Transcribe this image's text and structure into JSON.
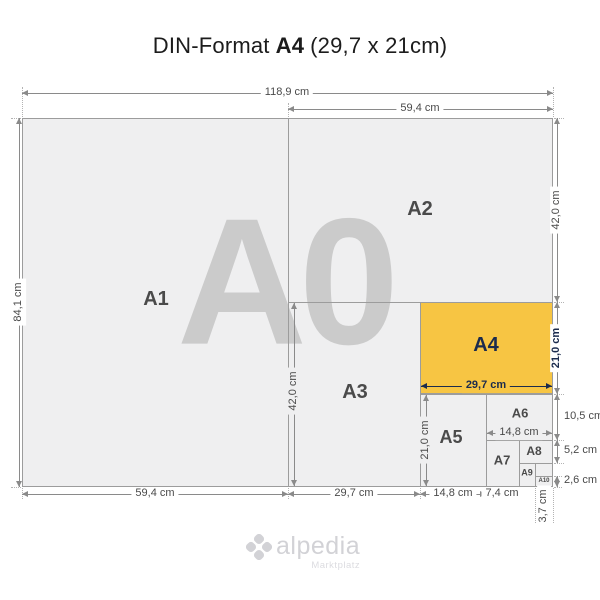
{
  "title": {
    "prefix": "DIN-Format",
    "highlight": "A4",
    "suffix": "(29,7 x 21cm)"
  },
  "watermark": "A0",
  "formats": {
    "a0": "A0",
    "a1": "A1",
    "a2": "A2",
    "a3": "A3",
    "a4": "A4",
    "a5": "A5",
    "a6": "A6",
    "a7": "A7",
    "a8": "A8",
    "a9": "A9",
    "a10": "A10"
  },
  "dims": {
    "total_width": "118,9 cm",
    "a2_width": "59,4 cm",
    "total_height": "84,1 cm",
    "a2_height": "42,0 cm",
    "a4_height": "21,0 cm",
    "a6_height": "10,5 cm",
    "a8_height": "5,2 cm",
    "a10_height": "2,6 cm",
    "a1_width": "59,4 cm",
    "a3_width": "29,7 cm",
    "a5_width": "14,8 cm",
    "a7_width": "7,4 cm",
    "a10_width": "3,7 cm",
    "a3_height": "42,0 cm",
    "a5_height": "21,0 cm",
    "a4_width": "29,7 cm",
    "a6_width": "14,8 cm"
  },
  "logo": {
    "icon": "clover-pinwheel-icon",
    "brand": "alpedia",
    "tagline": "Marktplatz"
  },
  "colors": {
    "highlight_fill": "#f7c543",
    "highlight_text": "#1b2b4d",
    "paper_fill": "#efeff0",
    "paper_border": "#9c9c9c",
    "watermark": "#cbcbcb",
    "dim_line": "#8a8a8a",
    "dim_text": "#4a4a4a"
  }
}
